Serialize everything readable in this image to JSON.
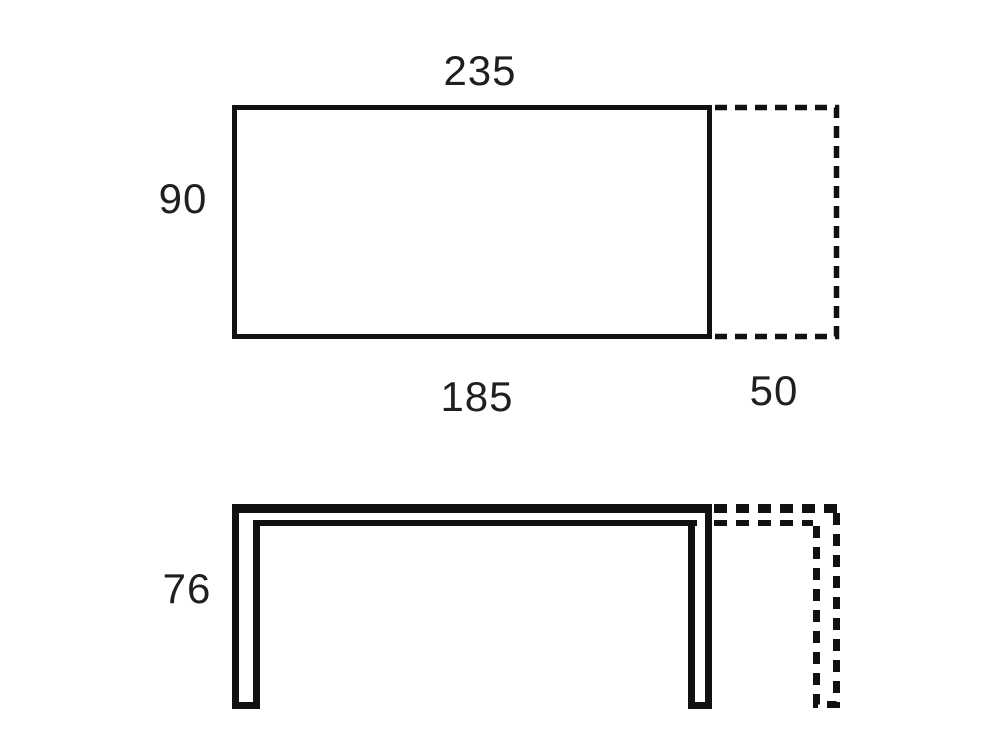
{
  "diagram": {
    "colors": {
      "line": "#111111",
      "text": "#1f1f1f",
      "background": "#ffffff"
    },
    "top_view": {
      "total_length_label": "235",
      "depth_label": "90",
      "fixed_length_label": "185",
      "extension_length_label": "50"
    },
    "front_view": {
      "height_label": "76"
    }
  }
}
